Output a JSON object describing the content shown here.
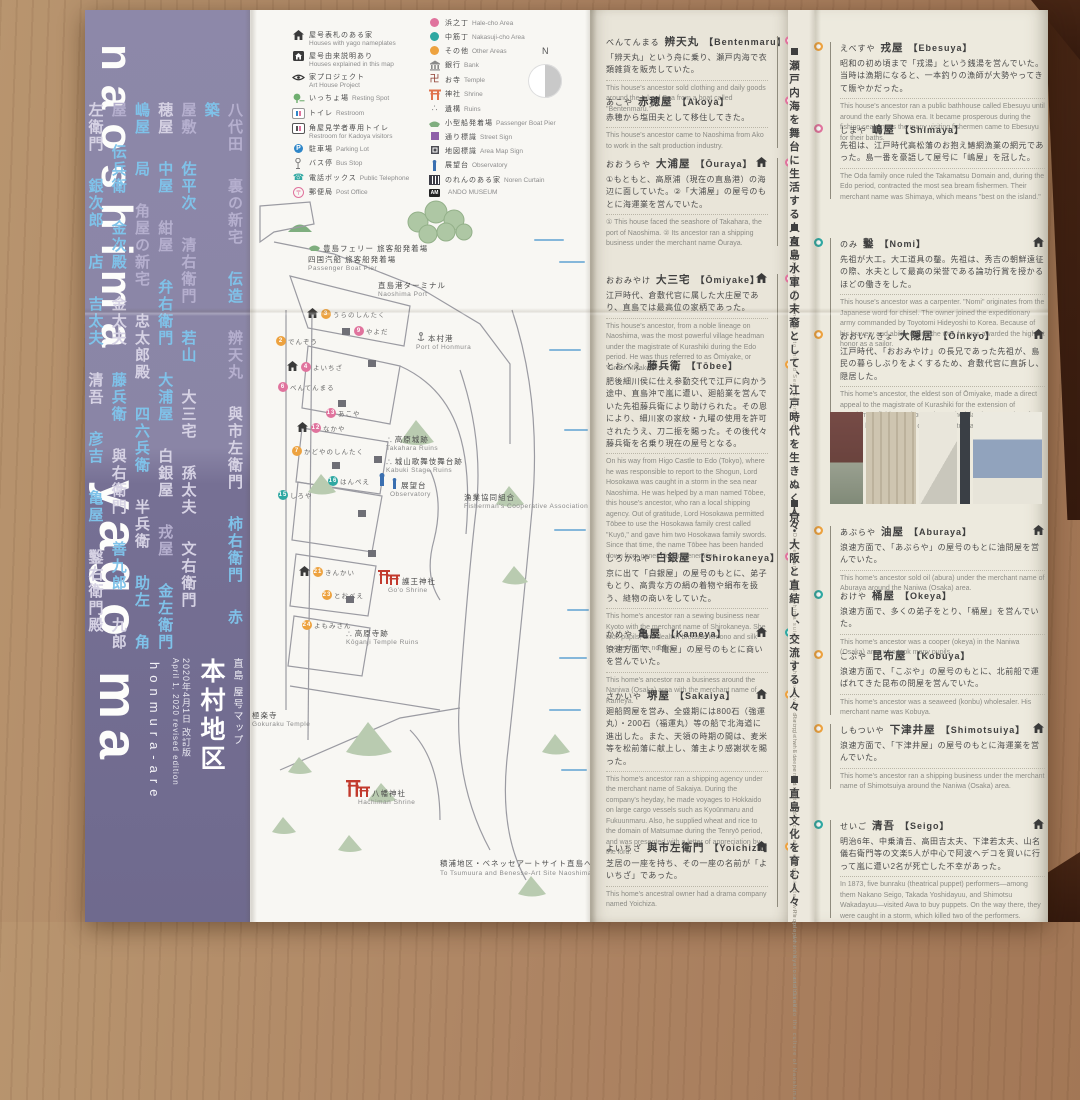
{
  "spine": {
    "word_top": "naoshima",
    "word_bottom": "yago ma",
    "subtitle": "honmura-are",
    "title_small": "直島 屋号マップ",
    "title_main": "本村地区",
    "date_jp": "2020年4月1日 改訂版",
    "date_en": "April 1, 2020 revised edition",
    "name_columns": [
      [
        {
          "t": "八代田",
          "c": "lav"
        },
        {
          "t": "裏の新宅",
          "c": "lav"
        },
        {
          "t": "伝造",
          "c": "blue"
        },
        {
          "t": "辨天丸",
          "c": "lav"
        },
        {
          "t": "與市左衛門",
          "c": "pale"
        },
        {
          "t": "柿右衛門",
          "c": "blue"
        },
        {
          "t": "赤",
          "c": "blue"
        },
        {
          "t": "築",
          "c": "blue"
        }
      ],
      [
        {
          "t": "屋敷",
          "c": "lav"
        },
        {
          "t": "佐平次",
          "c": "blue"
        },
        {
          "t": "清右衛門",
          "c": "lav"
        },
        {
          "t": "若山",
          "c": "blue"
        },
        {
          "t": "大三宅",
          "c": "pale"
        },
        {
          "t": "孫太夫",
          "c": "pale"
        },
        {
          "t": "文右衛門",
          "c": "pale"
        }
      ],
      [
        {
          "t": "穂屋",
          "c": "pale"
        },
        {
          "t": "中屋",
          "c": "blue"
        },
        {
          "t": "紺屋",
          "c": "lav"
        },
        {
          "t": "弁右衛門",
          "c": "blue"
        },
        {
          "t": "大浦屋",
          "c": "blue"
        },
        {
          "t": "白銀屋",
          "c": "pale"
        },
        {
          "t": "戎屋",
          "c": "lav"
        },
        {
          "t": "金左衛門",
          "c": "blue"
        }
      ],
      [
        {
          "t": "嶋屋",
          "c": "blue"
        },
        {
          "t": "局",
          "c": "blue"
        },
        {
          "t": "角屋の新宅",
          "c": "lav"
        },
        {
          "t": "忠太郎殿",
          "c": "pale"
        },
        {
          "t": "四六兵衛",
          "c": "blue"
        },
        {
          "t": "半兵衛",
          "c": "pale"
        },
        {
          "t": "助左",
          "c": "blue"
        },
        {
          "t": "角",
          "c": "blue"
        }
      ],
      [
        {
          "t": "屋",
          "c": "lav"
        },
        {
          "t": "伝兵衛",
          "c": "blue"
        },
        {
          "t": "金次殿",
          "c": "blue"
        },
        {
          "t": "金太夫",
          "c": "pale"
        },
        {
          "t": "藤兵衛",
          "c": "blue"
        },
        {
          "t": "與右衛門",
          "c": "pale"
        },
        {
          "t": "善九郎",
          "c": "blue"
        },
        {
          "t": "九郎",
          "c": "pale"
        }
      ],
      [
        {
          "t": "左衛門",
          "c": "pale"
        },
        {
          "t": "銀次郎",
          "c": "blue"
        },
        {
          "t": "店",
          "c": "blue"
        },
        {
          "t": "吉太夫",
          "c": "blue"
        },
        {
          "t": "清吾",
          "c": "pale"
        },
        {
          "t": "彦吉",
          "c": "blue"
        },
        {
          "t": "亀屋",
          "c": "blue"
        },
        {
          "t": "鑿右衛門殿",
          "c": "pale"
        }
      ]
    ]
  },
  "legend": {
    "compass": "N",
    "left": [
      {
        "icon": "house-icon",
        "jp": "屋号表札のある家",
        "en": "Houses with yago nameplates",
        "two": true
      },
      {
        "icon": "house-box-icon",
        "jp": "屋号由来説明あり",
        "en": "Houses explained in this map",
        "two": true
      },
      {
        "icon": "art-house-project-icon",
        "jp": "家プロジェクト",
        "en": "Art House Project",
        "two": true
      },
      {
        "icon": "resting-spot-icon",
        "jp": "いっちょ場",
        "en": "Resting Spot",
        "two": false
      },
      {
        "icon": "restroom-icon",
        "jp": "トイレ",
        "en": "Restroom",
        "two": false
      },
      {
        "icon": "kadoya-restroom-icon",
        "jp": "角屋見学者専用トイレ",
        "en": "Restroom for Kadoya visitors",
        "two": true
      },
      {
        "icon": "parking-icon",
        "jp": "駐車場",
        "en": "Parking Lot",
        "two": false
      },
      {
        "icon": "bus-stop-icon",
        "jp": "バス停",
        "en": "Bus Stop",
        "two": false
      },
      {
        "icon": "telephone-icon",
        "jp": "電話ボックス",
        "en": "Public Telephone",
        "two": false
      },
      {
        "icon": "post-office-icon",
        "jp": "郵便局",
        "en": "Post Office",
        "two": false
      }
    ],
    "right": [
      {
        "icon": "area-dot-pink-icon",
        "jp": "浜之丁",
        "en": "Hale-cho Area",
        "two": false
      },
      {
        "icon": "area-dot-teal-icon",
        "jp": "中筋丁",
        "en": "Nakasuji-cho Area",
        "two": false
      },
      {
        "icon": "area-dot-orange-icon",
        "jp": "その他",
        "en": "Other Areas",
        "two": false
      },
      {
        "icon": "bank-icon",
        "jp": "銀行",
        "en": "Bank",
        "two": false
      },
      {
        "icon": "temple-icon",
        "jp": "お寺",
        "en": "Temple",
        "two": false
      },
      {
        "icon": "shrine-icon",
        "jp": "神社",
        "en": "Shrine",
        "two": false
      },
      {
        "icon": "ruins-icon",
        "jp": "遺構",
        "en": "Ruins",
        "two": false
      },
      {
        "icon": "boat-icon",
        "jp": "小型船発着場",
        "en": "Passenger Boat Pier",
        "two": false
      },
      {
        "icon": "street-sign-icon",
        "jp": "通り標識",
        "en": "Street Sign",
        "two": false
      },
      {
        "icon": "map-sign-icon",
        "jp": "地図標識",
        "en": "Area Map Sign",
        "two": false
      },
      {
        "icon": "observatory-icon",
        "jp": "展望台",
        "en": "Observatory",
        "two": false
      },
      {
        "icon": "noren-icon",
        "jp": "のれんのある家",
        "en": "Noren Curtain",
        "two": false
      },
      {
        "icon": "ando-museum-badge",
        "jp": "",
        "en": "ANDO MUSEUM",
        "two": false
      }
    ]
  },
  "map": {
    "labels": [
      {
        "jp": "豊島フェリー 旅客船発着場",
        "jp2": "四国汽船 旅客船発着場",
        "en": "Passenger Boat Pier",
        "icon": "boat-icon",
        "x": 58,
        "y": 232
      },
      {
        "jp": "直島港ターミナル",
        "en": "Naoshima Port",
        "icon": "",
        "x": 128,
        "y": 270
      },
      {
        "jp": "本村港",
        "en": "Port of Honmura",
        "icon": "anchor-icon",
        "x": 166,
        "y": 322
      },
      {
        "jp": "高原城跡",
        "en": "Takahara Ruins",
        "icon": "ruins-icon",
        "x": 136,
        "y": 424
      },
      {
        "jp": "城山歌舞伎舞台跡",
        "en": "Kabuki Stage Ruins",
        "icon": "ruins-icon",
        "x": 136,
        "y": 446
      },
      {
        "jp": "展望台",
        "en": "Observatory",
        "icon": "observatory-icon",
        "x": 140,
        "y": 468
      },
      {
        "jp": "漁業協同組合",
        "en": "Fisherman's Cooperative Association",
        "icon": "",
        "x": 214,
        "y": 482
      },
      {
        "jp": "護王神社",
        "en": "Go'o Shrine",
        "icon": "torii-icon",
        "x": 138,
        "y": 564
      },
      {
        "jp": "高原寺跡",
        "en": "Kōganji Temple Ruins",
        "icon": "ruins-icon",
        "x": 96,
        "y": 618
      },
      {
        "jp": "八幡神社",
        "en": "Hachiman Shrine",
        "icon": "torii-icon",
        "x": 108,
        "y": 776
      },
      {
        "jp": "極楽寺",
        "en": "Gokuraku Temple",
        "icon": "",
        "x": 2,
        "y": 700
      },
      {
        "jp": "積浦地区・ベネッセアートサイト直島へ",
        "en": "To Tsumuura and Benesse-Art Site Naoshima ↘",
        "icon": "",
        "x": 190,
        "y": 848
      }
    ],
    "house_labels": [
      {
        "t": "うらのしんたく",
        "n": "3",
        "c": "orange",
        "x": 56,
        "y": 298,
        "house": true
      },
      {
        "t": "でんぞう",
        "n": "2",
        "c": "orange",
        "x": 26,
        "y": 326,
        "house": false
      },
      {
        "t": "よいちざ",
        "n": "4",
        "c": "pink",
        "x": 36,
        "y": 351,
        "house": true
      },
      {
        "t": "べんてんまる",
        "n": "6",
        "c": "pink",
        "x": 28,
        "y": 372,
        "house": false
      },
      {
        "t": "やよだ",
        "n": "9",
        "c": "pink",
        "x": 104,
        "y": 316,
        "house": false
      },
      {
        "t": "なかや",
        "n": "12",
        "c": "pink",
        "x": 46,
        "y": 412,
        "house": true
      },
      {
        "t": "あこや",
        "n": "13",
        "c": "pink",
        "x": 76,
        "y": 398,
        "house": false
      },
      {
        "t": "かどやのしんたく",
        "n": "7",
        "c": "orange",
        "x": 42,
        "y": 436,
        "house": false
      },
      {
        "t": "しろや",
        "n": "15",
        "c": "teal",
        "x": 28,
        "y": 480,
        "house": false
      },
      {
        "t": "はんぺえ",
        "n": "16",
        "c": "teal",
        "x": 78,
        "y": 466,
        "house": false
      },
      {
        "t": "きんかい",
        "n": "21",
        "c": "orange",
        "x": 48,
        "y": 556,
        "house": true
      },
      {
        "t": "とおべえ",
        "n": "23",
        "c": "orange",
        "x": 72,
        "y": 580,
        "house": false
      },
      {
        "t": "よもみさん",
        "n": "24",
        "c": "orange",
        "x": 52,
        "y": 610,
        "house": false
      }
    ]
  },
  "groups": [
    {
      "jp": "瀬戸内海を舞台に生活する人々",
      "en": "People who lived on the Seto Inland Sea (Setonaikai)"
    },
    {
      "jp": "直島水軍の末裔として、江戸時代を生きぬく人々",
      "en": "Descendants of Naoshima suigun navy who survived during the Edo period"
    },
    {
      "jp": "京・大阪と直結し、交流する人々",
      "en": "People who were connected directly and communicated with people in Kyoto and Osaka"
    },
    {
      "jp": "直島文化を育む人々",
      "en": "People who have contributed to the culture of Naoshima"
    }
  ],
  "column1": [
    {
      "kana": "べんてんまる",
      "kanji": "辨天丸",
      "romaji": "Bentenmaru",
      "marker": "pink",
      "house": false,
      "jp": "「辨天丸」という舟に乗り、瀬戸内海で衣類雑貨を販売していた。",
      "en": "This house's ancestor sold clothing and daily goods around the Inland Sea from a boat called \"Bentenmaru.\""
    },
    {
      "kana": "あこや",
      "kanji": "赤穂屋",
      "romaji": "Akoya",
      "marker": "pink",
      "house": false,
      "jp": "赤穂から塩田夫として移住してきた。",
      "en": "This house's ancestor came to Naoshima from Ako to work in the salt production industry."
    },
    {
      "kana": "おおうらや",
      "kanji": "大浦屋",
      "romaji": "Ōuraya",
      "marker": "pink",
      "house": true,
      "jp": "①もともと、高原浦（現在の直島港）の海辺に面していた。②「大浦屋」の屋号のもとに海運業を営んでいた。",
      "en": "① This house faced the seashore of Takahara, the port of Naoshima. ② Its ancestor ran a shipping business under the merchant name Ōuraya."
    },
    {
      "kana": "おおみやけ",
      "kanji": "大三宅",
      "romaji": "Ōmiyake",
      "marker": "pink",
      "house": true,
      "jp": "江戸時代、倉敷代官に属した大庄屋であり、直島では最高位の家柄であった。",
      "en": "This house's ancestor, from a noble lineage on Naoshima, was the most powerful village headman under the magistrate of Kurashiki during the Edo period. He was thus referred to as Ōmiyake, or \"Great Miyake.\""
    },
    {
      "kana": "とおべえ",
      "kanji": "藤兵衛",
      "romaji": "Tōbee",
      "marker": "orange",
      "house": false,
      "jp": "肥後細川侯に仕え参勤交代で江戸に向かう途中、直島沖で嵐に遭い、廻船業を営んでいた先祖藤兵衛により助けられた。その恩により、細川家の家紋・九曜の使用を許可されたうえ、刀二振を賜った。その後代々藤兵衛を名乗り現在の屋号となる。",
      "en": "On his way from Higo Castle to Edo (Tokyo), where he was responsible to report to the Shogun, Lord Hosokawa was caught in a storm in the sea near Naoshima. He was helped by a man named Tōbee, this house's ancestor, who ran a local shipping agency. Out of gratitude, Lord Hosokawa permitted Tōbee to use the Hosokawa family crest called \"Kuyō,\" and gave him two Hosokawa family swords. Since that time, the name Tōbee has been handed down from generation to generation."
    },
    {
      "kana": "しろかねや",
      "kanji": "白銀屋",
      "romaji": "Shirokaneya",
      "marker": "pink",
      "house": false,
      "jp": "京に出て「白銀屋」の屋号のもとに、弟子もとり、高貴な方の絹の着物や絹布を扱う、縫物の商いをしていた。",
      "en": "This home's ancestor ran a sewing business near Kyoto with the merchant name of Shirokaneya. She took pupils, and dealt in brocade kimono and silk textiles for the nobility."
    },
    {
      "kana": "かめや",
      "kanji": "亀屋",
      "romaji": "Kameya",
      "marker": "teal",
      "house": true,
      "jp": "浪速方面で、「亀屋」の屋号のもとに商いを営んでいた。",
      "en": "This home's ancestor ran a business around the Naniwa (Osaka) area with the merchant name of Kameya."
    },
    {
      "kana": "さかいや",
      "kanji": "堺屋",
      "romaji": "Sakaiya",
      "marker": "orange",
      "house": true,
      "jp": "廻船問屋を営み、全盛期には800石（強運丸）・200石（福運丸）等の船で北海道に進出した。また、天領の時期の間は、麦米等を松前藩に献上し、藩主より感謝状を賜った。",
      "en": "This home's ancestor ran a shipping agency under the merchant name of Sakaiya. During the company's heyday, he made voyages to Hokkaido on large cargo vessels such as Kyoūnmaru and Fukuunmaru. Also, he supplied wheat and rice to the domain of Matsumae during the Tenryō period, and was presented with a letter of appreciation by the lord."
    },
    {
      "kana": "よいちざ",
      "kanji": "與市左衛門",
      "romaji": "Yoichiza",
      "marker": "orange",
      "house": true,
      "jp": "芝居の一座を持ち、その一座の名前が「よいちざ」であった。",
      "en": "This home's ancestral owner had a drama company named Yoichiza."
    }
  ],
  "column2": [
    {
      "kana": "えべすや",
      "kanji": "戎屋",
      "romaji": "Ebesuya",
      "marker": "orange",
      "house": false,
      "jp": "昭和の初め頃まで「戎湯」という銭湯を営んでいた。当時は漁期になると、一本釣りの漁師が大勢やってきて賑やかだった。",
      "en": "This house's ancestor ran a public bathhouse called Ebesuyu until around the early Showa era. It became prosperous during the fishing season, as the many visiting fishermen came to Ebesuyu for their baths."
    },
    {
      "kana": "しまや",
      "kanji": "嶋屋",
      "romaji": "Shimaya",
      "marker": "pink",
      "house": false,
      "jp": "先祖は、江戸時代高松藩のお抱え鰆網漁業の網元であった。島一番を豪語して屋号に「嶋屋」を冠した。",
      "en": "The Oda family once ruled the Takamatsu Domain and, during the Edo period, contracted the most sea bream fishermen. Their merchant name was Shimaya, which means \"best on the island.\""
    },
    {
      "kana": "のみ",
      "kanji": "鑿",
      "romaji": "Nomi",
      "marker": "teal",
      "house": true,
      "jp": "先祖が大工。大工道具の鑿。先祖は、秀吉の朝鮮遠征の際、水夫として最高の栄誉である論功行賞を授かるほどの働きをした。",
      "en": "This house's ancestor was a carpenter. \"Nomi\" originates from the Japanese word for chisel. The owner joined the expeditionary army commanded by Toyotomi Hideyoshi to Korea. Because of his bravery and ability during the war, he was awarded the highest honor as a sailor."
    },
    {
      "kana": "おおいんきょ",
      "kanji": "大隠居",
      "romaji": "Ōinkyo",
      "marker": "orange",
      "house": true,
      "jp": "江戸時代、「おおみやけ」の長兄であった先祖が、島民の暮らしぶりをよくするため、倉敷代官に直訴し、隠居した。",
      "en": "This home's ancestor, the eldest son of Ōmiyake, made a direct appeal to the magistrate of Kurashiki for the extension of Naoshima's fishing territory to boost the island's prosperity. After that, he became \"inkyo,\" or retired status, and lived a quiet life."
    },
    {
      "kana": "あぶらや",
      "kanji": "油屋",
      "romaji": "Aburaya",
      "marker": "orange",
      "house": true,
      "jp": "浪速方面で、「あぶらや」の屋号のもとに油問屋を営んでいた。",
      "en": "This home's ancestor sold oil (abura) under the merchant name of Aburaya around the Naniwa (Osaka) area."
    },
    {
      "kana": "おけや",
      "kanji": "桶屋",
      "romaji": "Okeya",
      "marker": "teal",
      "house": false,
      "jp": "浪速方面で、多くの弟子をとり、「桶屋」を営んでいた。",
      "en": "This home's ancestor was a cooper (okeya) in the Naniwa (Osaka) area who took many pupils."
    },
    {
      "kana": "こぶや",
      "kanji": "昆布屋",
      "romaji": "Kobuya",
      "marker": "orange",
      "house": false,
      "jp": "浪速方面で、「こぶや」の屋号のもとに、北前船で運ばれてきた昆布の問屋を営んでいた。",
      "en": "This home's ancestor was a seaweed (konbu) wholesaler. His merchant name was Kobuya."
    },
    {
      "kana": "しもついや",
      "kanji": "下津井屋",
      "romaji": "Shimotsuiya",
      "marker": "orange",
      "house": true,
      "jp": "浪速方面で、「下津井屋」の屋号のもとに海運業を営んでいた。",
      "en": "This home's ancestor ran a shipping business under the merchant name of Shimotsuiya around the Naniwa (Osaka) area."
    },
    {
      "kana": "せいご",
      "kanji": "清吾",
      "romaji": "Seigo",
      "marker": "teal",
      "house": true,
      "jp": "明治6年、中乗清吾、高田吉太夫、下津若太夫、山名儀右衛門等の文楽5人が中心で阿波へデコを買いに行って嵐に遭い2名が死亡した不幸があった。",
      "en": "In 1873, five bunraku (theatrical puppet) performers—among them Nakano Seigo, Takada Yoshidayuu, and Shimotsu Wakadayuu—visited Awa to buy puppets. On the way there, they were caught in a storm, which killed two of the performers."
    }
  ]
}
